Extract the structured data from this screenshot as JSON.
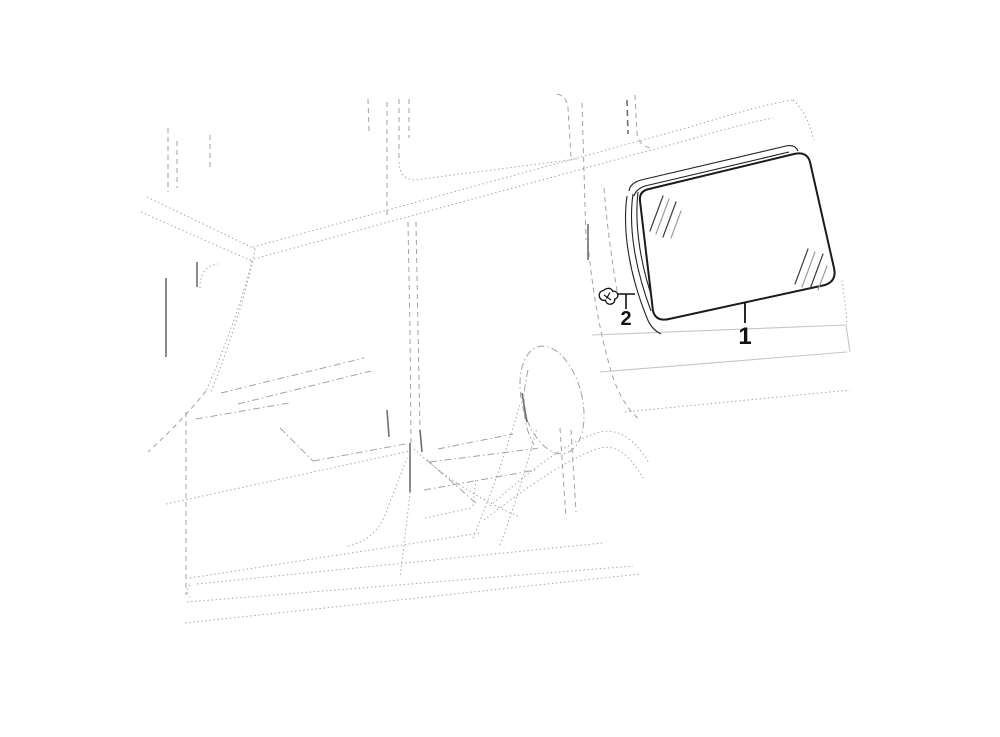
{
  "diagram": {
    "background_color": "#ffffff",
    "body_outline_color": "#a2a2a2",
    "part_line_color": "#1b1b1b",
    "panel_line_color": "#c6c6c6",
    "parts": [
      {
        "callout": "1",
        "name": "quarter-window-glass"
      },
      {
        "callout": "2",
        "name": "glass-retainer-clip"
      }
    ]
  }
}
